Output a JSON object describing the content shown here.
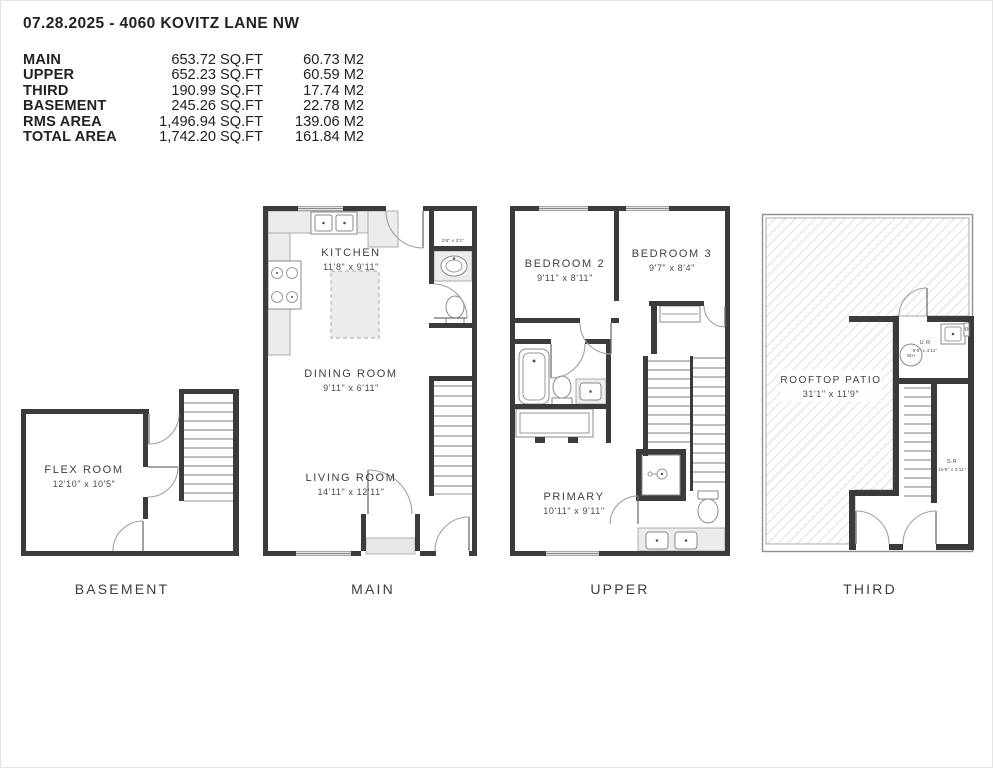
{
  "header": {
    "title": "07.28.2025 - 4060 KOVITZ LANE NW",
    "area_table": {
      "rows": [
        {
          "label": "MAIN",
          "sqft": "653.72 SQ.FT",
          "m2": "60.73 M2"
        },
        {
          "label": "UPPER",
          "sqft": "652.23 SQ.FT",
          "m2": "60.59 M2"
        },
        {
          "label": "THIRD",
          "sqft": "190.99 SQ.FT",
          "m2": "17.74 M2"
        },
        {
          "label": "BASEMENT",
          "sqft": "245.26 SQ.FT",
          "m2": "22.78 M2"
        },
        {
          "label": "RMS AREA",
          "sqft": "1,496.94 SQ.FT",
          "m2": "139.06 M2"
        },
        {
          "label": "TOTAL AREA",
          "sqft": "1,742.20 SQ.FT",
          "m2": "161.84 M2"
        }
      ]
    }
  },
  "floors": {
    "basement": {
      "label": "BASEMENT",
      "flex_room": {
        "name": "FLEX ROOM",
        "dims": "12'10\" x 10'5\""
      }
    },
    "main": {
      "label": "MAIN",
      "kitchen": {
        "name": "KITCHEN",
        "dims": "11'8\" x 9'11\""
      },
      "dining": {
        "name": "DINING ROOM",
        "dims": "9'11\" x 6'11\""
      },
      "living": {
        "name": "LIVING ROOM",
        "dims": "14'11\" x 12'11\""
      },
      "closet_dims": "3'6\" x 2'1\""
    },
    "upper": {
      "label": "UPPER",
      "bedroom2": {
        "name": "BEDROOM 2",
        "dims": "9'11\" x 8'11\""
      },
      "bedroom3": {
        "name": "BEDROOM 3",
        "dims": "9'7\" x 8'4\""
      },
      "primary": {
        "name": "PRIMARY",
        "dims": "10'11\" x 9'11\""
      }
    },
    "third": {
      "label": "THIRD",
      "patio": {
        "name": "ROOFTOP PATIO",
        "dims": "31'1\" x 11'9\""
      },
      "utility": {
        "name": "U.R",
        "dims": "6'6\" x 4'11\""
      },
      "storage": {
        "name": "S.R",
        "dims": "15'6\" x 2'11\""
      },
      "water_heater": "WH"
    }
  },
  "colors": {
    "wall": "#3b3b3b",
    "counter": "#ececec",
    "hatch": "#d8d8d8"
  }
}
